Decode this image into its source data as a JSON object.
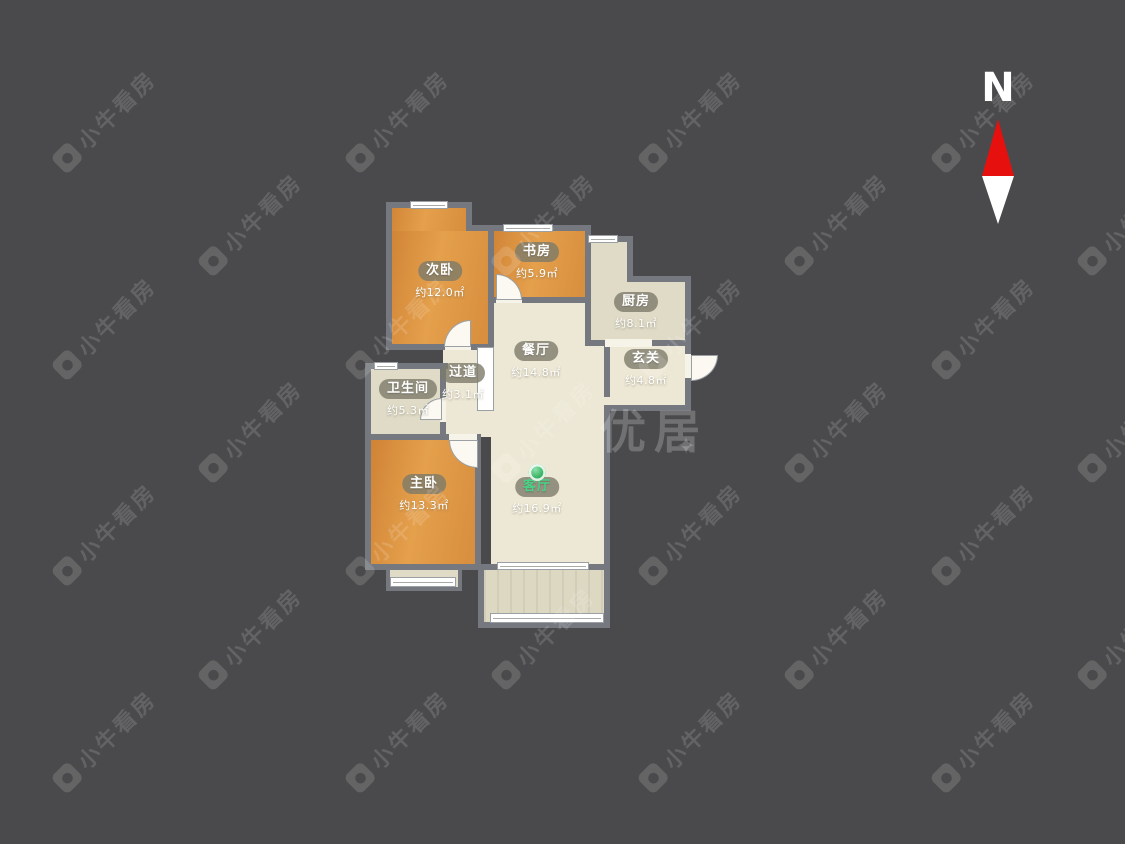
{
  "compass": {
    "label": "N"
  },
  "watermark": {
    "text": "小牛看房",
    "big_text": "优居",
    "star": "✦"
  },
  "colors": {
    "background": "#4a4a4c",
    "wall": "#75797f",
    "bedroom_floor": "#d98c3f",
    "living_floor": "#ede8d5",
    "service_floor": "#dfdbc7",
    "accent_green": "#2fae5a",
    "north_red": "#e6100f"
  },
  "rooms": [
    {
      "name": "次卧",
      "area": "约12.0㎡"
    },
    {
      "name": "书房",
      "area": "约5.9㎡"
    },
    {
      "name": "厨房",
      "area": "约8.1㎡"
    },
    {
      "name": "餐厅",
      "area": "约14.8㎡"
    },
    {
      "name": "玄关",
      "area": "约4.8㎡"
    },
    {
      "name": "过道",
      "area": "约3.1㎡"
    },
    {
      "name": "卫生间",
      "area": "约5.3㎡"
    },
    {
      "name": "主卧",
      "area": "约13.3㎡"
    },
    {
      "name": "客厅",
      "area": "约16.9㎡",
      "highlight": "green-pin"
    }
  ]
}
